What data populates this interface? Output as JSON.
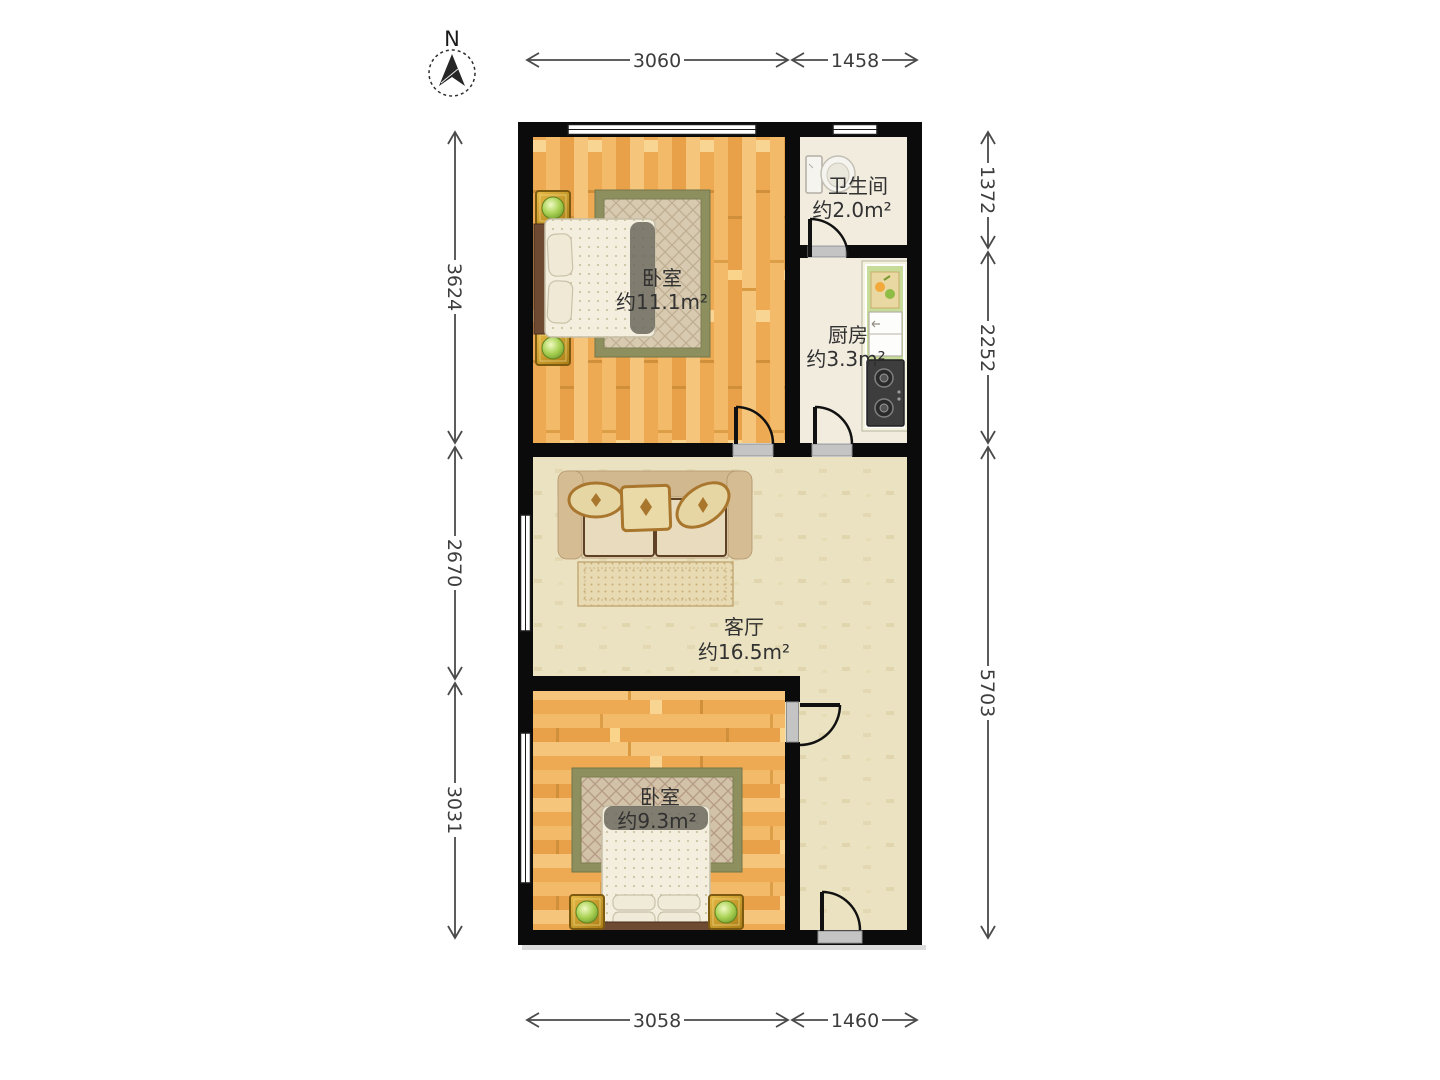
{
  "compass": {
    "label": "N"
  },
  "rooms": [
    {
      "id": "bedroom-top",
      "name": "卧室",
      "area": "约11.1m²"
    },
    {
      "id": "bathroom",
      "name": "卫生间",
      "area": "约2.0m²"
    },
    {
      "id": "kitchen",
      "name": "厨房",
      "area": "约3.3m²"
    },
    {
      "id": "living-room",
      "name": "客厅",
      "area": "约16.5m²"
    },
    {
      "id": "bedroom-bottom",
      "name": "卧室",
      "area": "约9.3m²"
    }
  ],
  "dimensions": {
    "top": [
      "3060",
      "1458"
    ],
    "bottom": [
      "3058",
      "1460"
    ],
    "left": [
      "3624",
      "2670",
      "3031"
    ],
    "right": [
      "1372",
      "2252",
      "5703"
    ]
  },
  "colors": {
    "wall": "#0b0b0b",
    "wood_floor": "#f0b05c",
    "living_floor": "#ebe2c2",
    "tile_floor": "#f2ecdf",
    "counter_green": "#c8dc9a",
    "rug_border_olive": "#8d8f5f",
    "dimension_line": "#4a4a4a"
  }
}
